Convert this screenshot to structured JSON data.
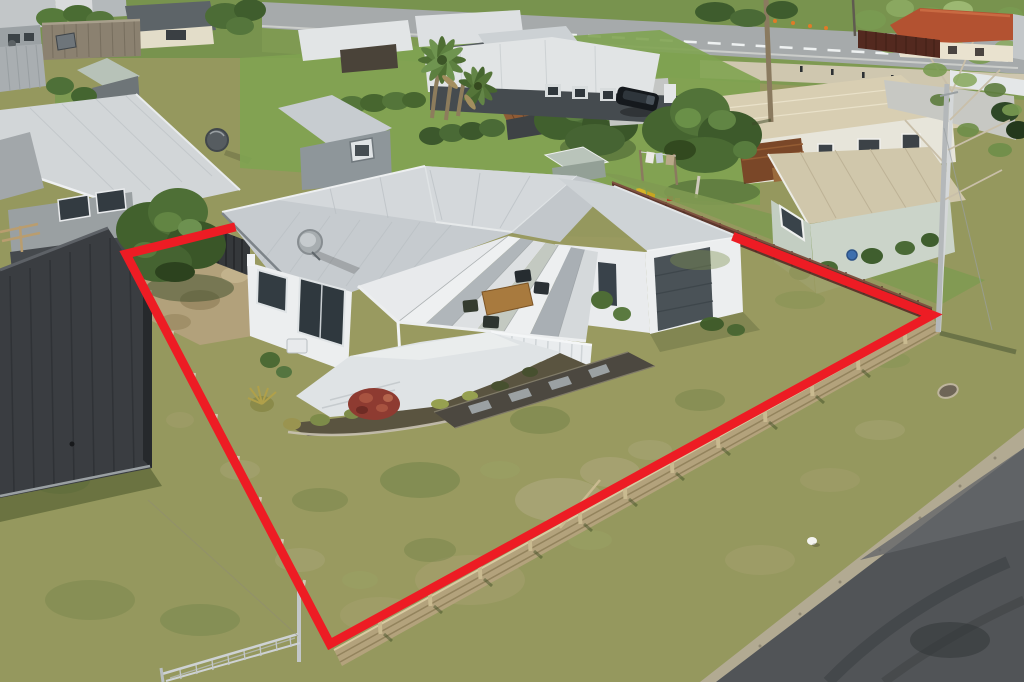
{
  "scene": {
    "type": "aerial-drone-photograph",
    "subject": "White weatherboard single-level house with grey metal roof, front veranda, deck and attached garage on a fenced grass section, property boundary outlined in red",
    "setting": "Suburban neighbourhood: street along the top, neighbouring houses and sheds, timber and paling fences, large trees, sealed road at lower right"
  },
  "boundary": {
    "points": "231,228 126,254 330,644 932,315 737,238",
    "color": "#ed1c24",
    "stroke_width": 9
  },
  "palette": {
    "lawn": "#95985e",
    "verge_grass": "#7f9a52",
    "street": "#a6aaab",
    "road": "#515457",
    "gravel_edge": "#b2aa92",
    "roof": "#c6cbcf",
    "roof_highlight": "#d4d8db",
    "house_wall": "#eceeef",
    "deck": "#dfe3e5",
    "timber_fence": "#b3a27c",
    "paling_fence": "#5d372c",
    "tree_green": "#4f7035",
    "dirt": "#b2a17b",
    "red_bush": "#8e3b31"
  }
}
